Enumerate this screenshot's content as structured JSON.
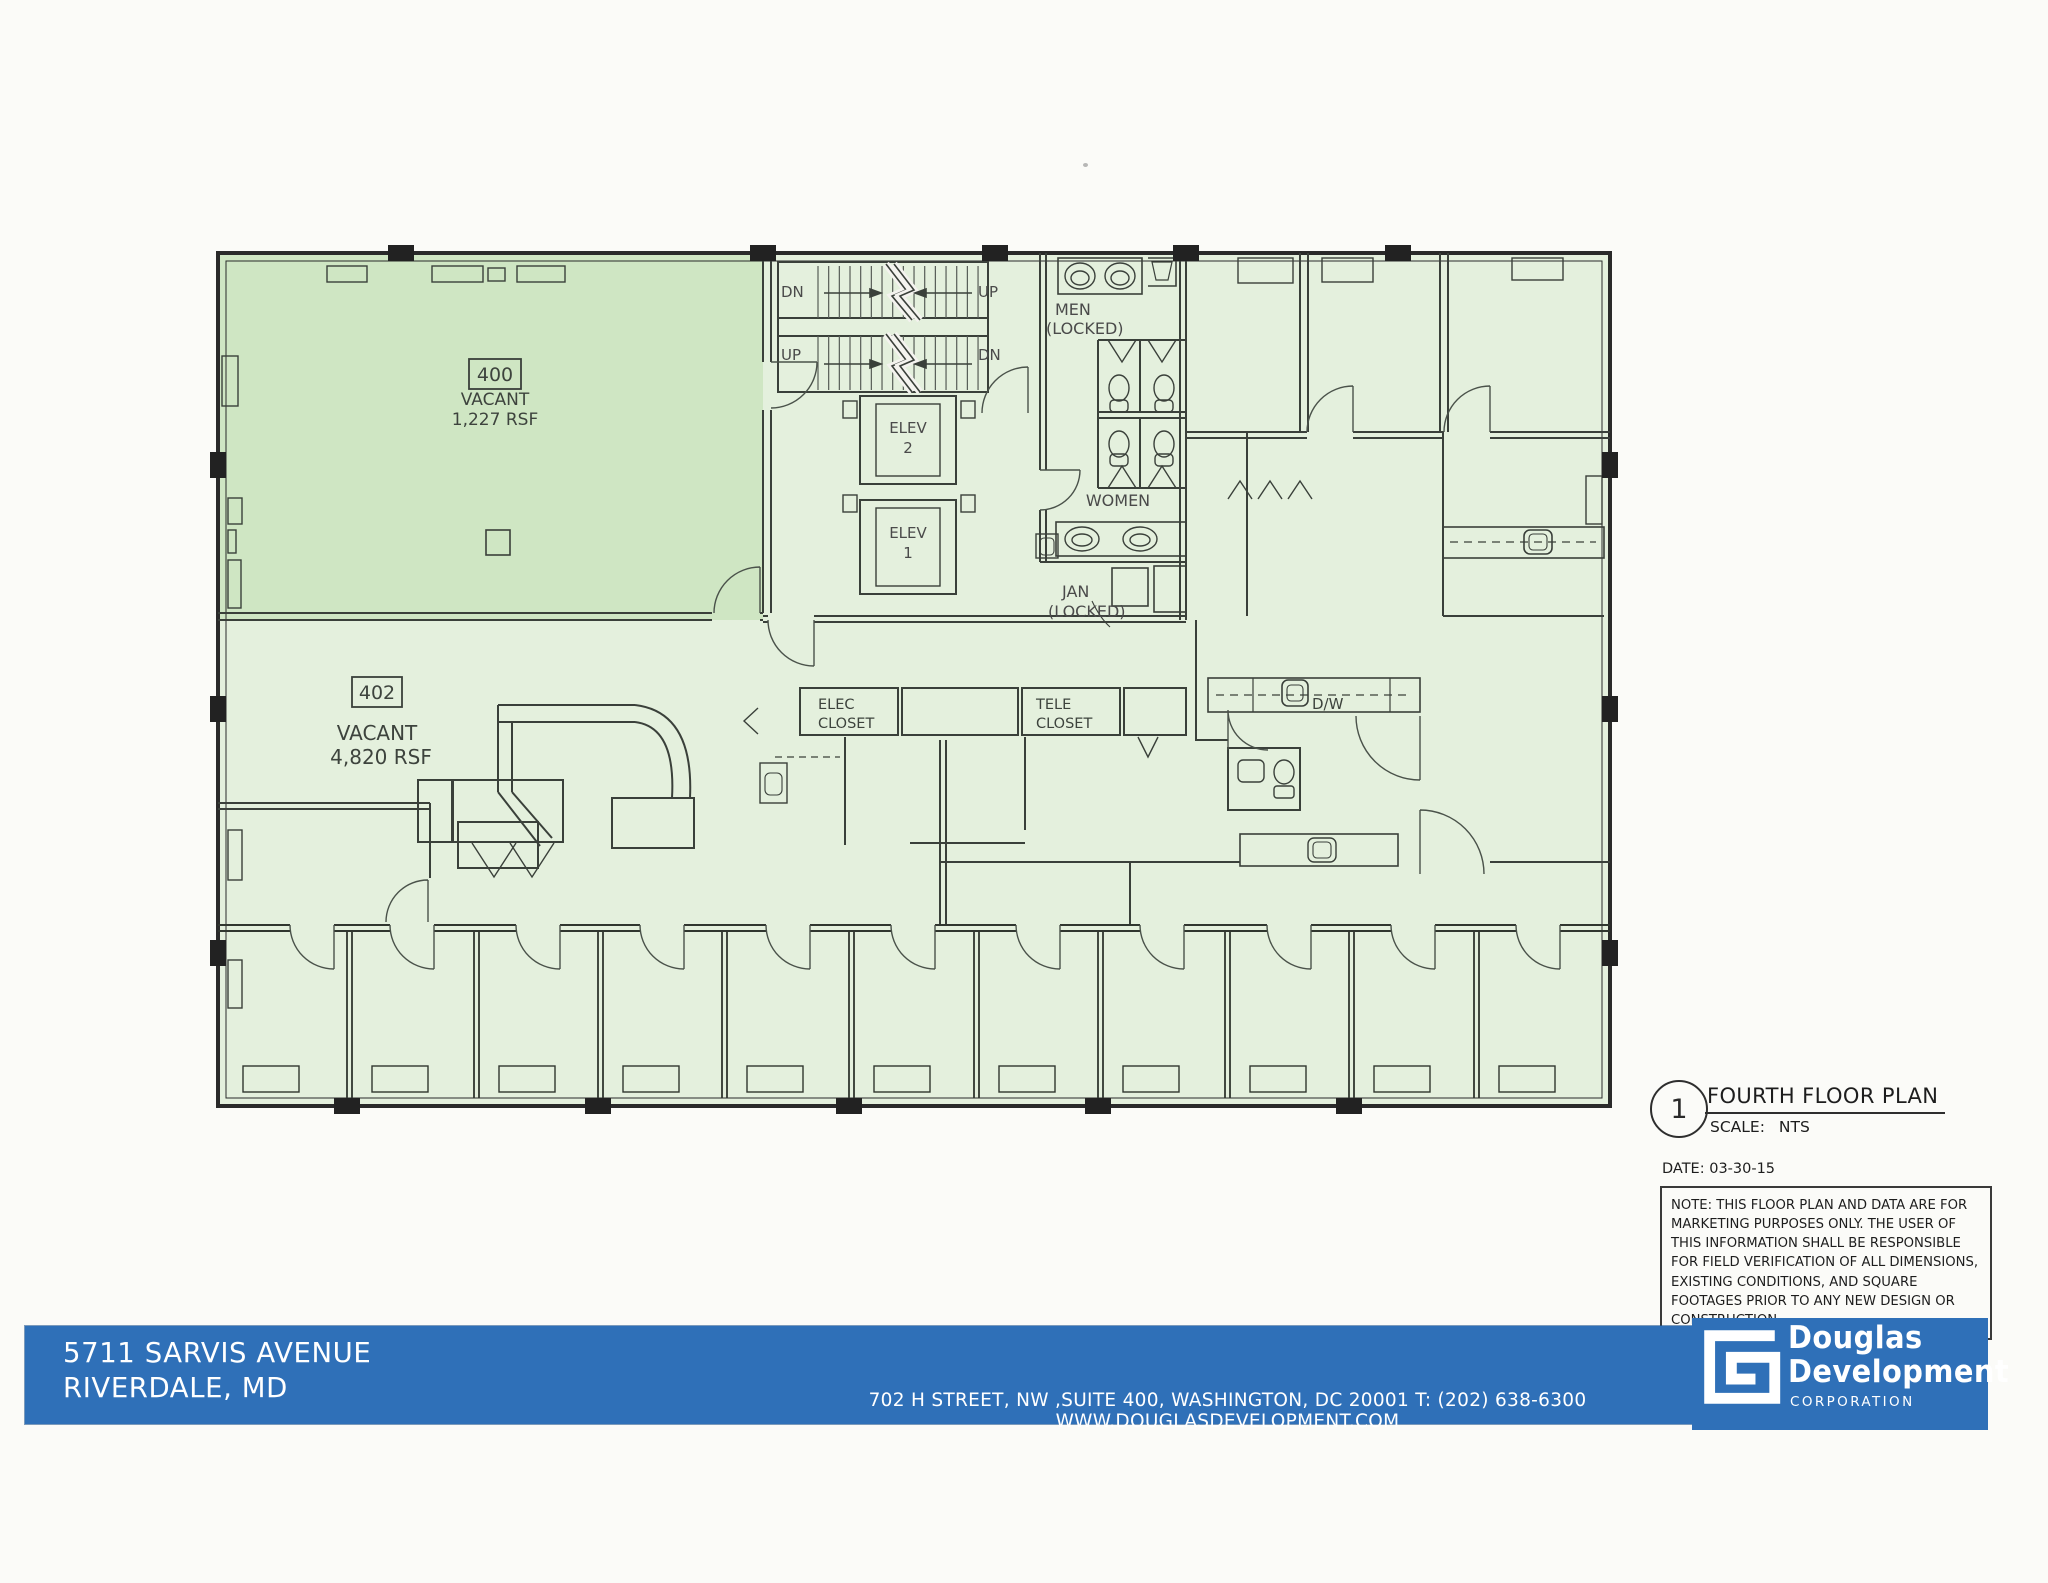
{
  "plan": {
    "suite400": {
      "number": "400",
      "status": "VACANT",
      "area": "1,227 RSF"
    },
    "suite402": {
      "number": "402",
      "status": "VACANT",
      "area": "4,820 RSF"
    },
    "stairs": {
      "dn1": "DN",
      "up1": "UP",
      "up2": "UP",
      "dn2": "DN"
    },
    "elev2": {
      "l1": "ELEV",
      "l2": "2"
    },
    "elev1": {
      "l1": "ELEV",
      "l2": "1"
    },
    "restrooms": {
      "men_l1": "MEN",
      "men_l2": "(LOCKED)",
      "women": "WOMEN",
      "jan_l1": "JAN",
      "jan_l2": "(LOCKED)"
    },
    "closets": {
      "elec_l1": "ELEC",
      "elec_l2": "CLOSET",
      "tele_l1": "TELE",
      "tele_l2": "CLOSET"
    },
    "dw": "D/W"
  },
  "title_block": {
    "detail_number": "1",
    "title": "FOURTH FLOOR PLAN",
    "scale_label": "SCALE:",
    "scale_value": "NTS",
    "date": "DATE: 03-30-15",
    "note": "NOTE:  THIS FLOOR PLAN AND DATA ARE FOR MARKETING PURPOSES ONLY.  THE USER OF THIS INFORMATION SHALL BE RESPONSIBLE FOR FIELD VERIFICATION OF ALL DIMENSIONS, EXISTING CONDITIONS, AND SQUARE FOOTAGES PRIOR TO ANY NEW DESIGN OR CONSTRUCTION."
  },
  "footer": {
    "property_line1": "5711 SARVIS AVENUE",
    "property_line2": "RIVERDALE, MD",
    "contact": "702 H STREET, NW ,SUITE 400, WASHINGTON, DC 20001   T: (202) 638-6300   WWW.DOUGLASDEVELOPMENT.COM",
    "logo_line1": "Douglas",
    "logo_line2": "Development",
    "logo_line3": "CORPORATION"
  },
  "colors": {
    "bar_blue": "#2f70b8",
    "suite400_green": "#cfe6c3",
    "suite402_green": "#e4f0dd",
    "core_grey": "#f4f3ef"
  }
}
